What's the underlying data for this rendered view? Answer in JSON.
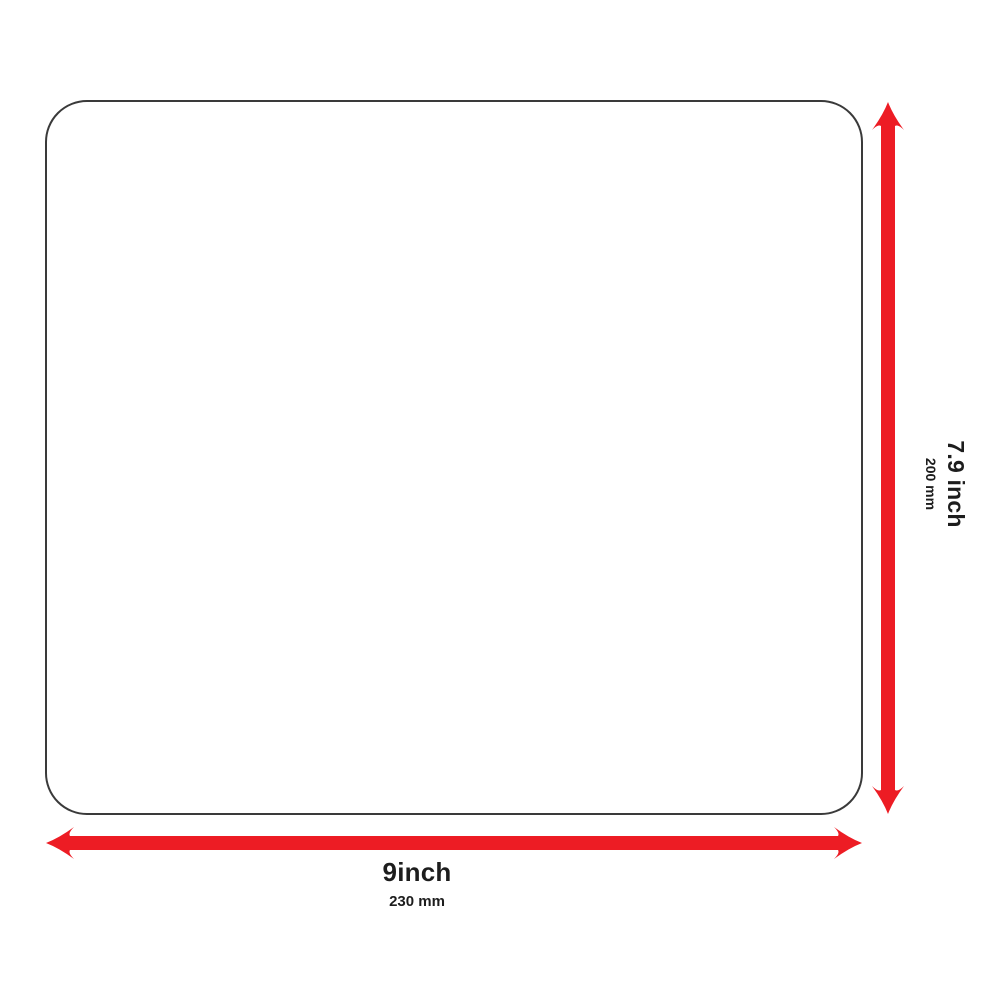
{
  "diagram": {
    "type": "product-dimension-diagram",
    "colors": {
      "arrow_red": "#ED1C24",
      "panel_border": "#3A3A3A",
      "text": "#1D1D1D",
      "background": "#FFFFFF"
    },
    "icons": {
      "width_arrow": "double-headed-arrow-horizontal",
      "height_arrow": "double-headed-arrow-vertical"
    },
    "width_dimension": {
      "primary": "9inch",
      "secondary": "230 mm"
    },
    "height_dimension": {
      "primary": "7.9 inch",
      "secondary": "200 mm"
    }
  }
}
